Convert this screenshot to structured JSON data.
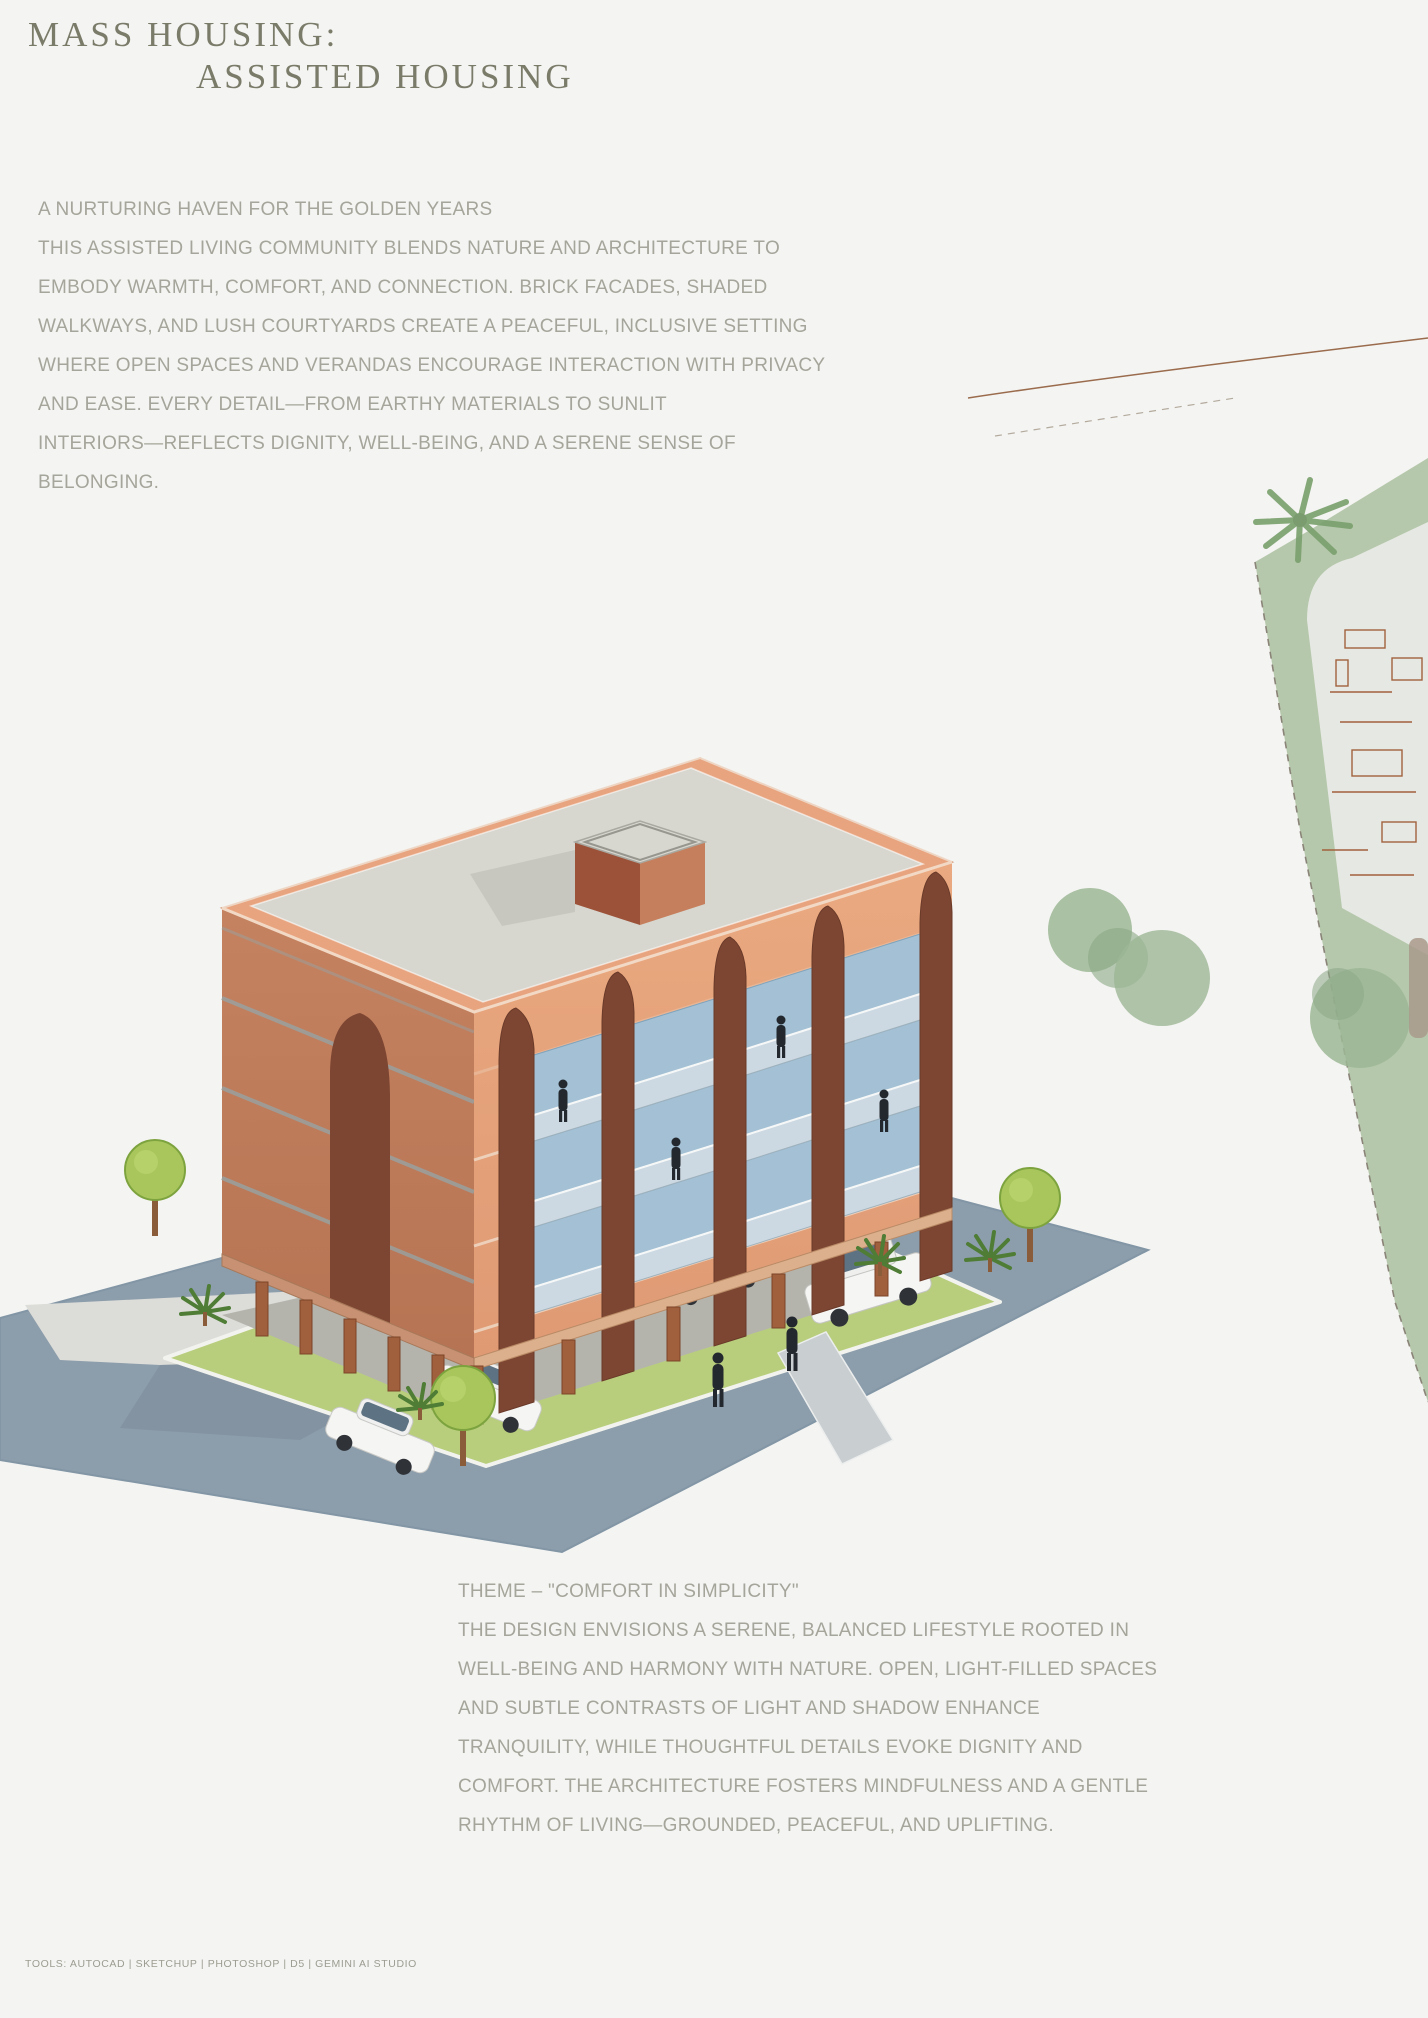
{
  "page": {
    "background": "#f4f4f2"
  },
  "header": {
    "title_line1": "MASS HOUSING:",
    "title_line2": "ASSISTED HOUSING"
  },
  "intro": {
    "lines": [
      "A NURTURING HAVEN FOR THE GOLDEN YEARS",
      "THIS ASSISTED LIVING COMMUNITY BLENDS NATURE AND ARCHITECTURE TO",
      "EMBODY WARMTH, COMFORT, AND CONNECTION. BRICK FACADES, SHADED",
      "WALKWAYS, AND LUSH COURTYARDS CREATE A PEACEFUL, INCLUSIVE SETTING",
      "WHERE OPEN SPACES AND VERANDAS ENCOURAGE INTERACTION WITH PRIVACY",
      "AND EASE. EVERY DETAIL—FROM EARTHY MATERIALS TO SUNLIT",
      "INTERIORS—REFLECTS DIGNITY, WELL-BEING, AND A SERENE SENSE OF",
      "BELONGING."
    ]
  },
  "theme": {
    "lines": [
      "THEME – \"COMFORT IN SIMPLICITY\"",
      "THE DESIGN ENVISIONS A SERENE, BALANCED LIFESTYLE ROOTED IN",
      "WELL-BEING AND HARMONY WITH NATURE. OPEN, LIGHT-FILLED SPACES",
      "AND SUBTLE CONTRASTS OF LIGHT AND SHADOW ENHANCE",
      "TRANQUILITY, WHILE THOUGHTFUL DETAILS EVOKE DIGNITY AND",
      "COMFORT. THE ARCHITECTURE FOSTERS MINDFULNESS AND A GENTLE",
      "RHYTHM OF LIVING—GROUNDED, PEACEFUL, AND UPLIFTING."
    ]
  },
  "footer": {
    "tools": "TOOLS: AUTOCAD | SKETCHUP | PHOTOSHOP | D5 | GEMINI AI STUDIO"
  },
  "illustration": {
    "caption": "Isometric render of a four-storey brick assisted-living block on pilotis with parking, lawns, trees and a corner road",
    "colors": {
      "front_wall": "#e6a37f",
      "side_wall": "#bf7d5e",
      "arch_brick": "#7d4632",
      "roof": "#d7d7d0",
      "glass": "#a3c0d4",
      "lawn": "#b8ce7d",
      "road": "#8c9dab",
      "column": "#a05f3d",
      "accent_car": "#e3b13e"
    }
  },
  "site_plan": {
    "caption": "Partial site plan fragment with sage landscaping and floor plan linework",
    "colors": {
      "landscape": "#b6c8ac",
      "pad": "#e6e9e3",
      "plan_lines": "#a2613d"
    }
  }
}
